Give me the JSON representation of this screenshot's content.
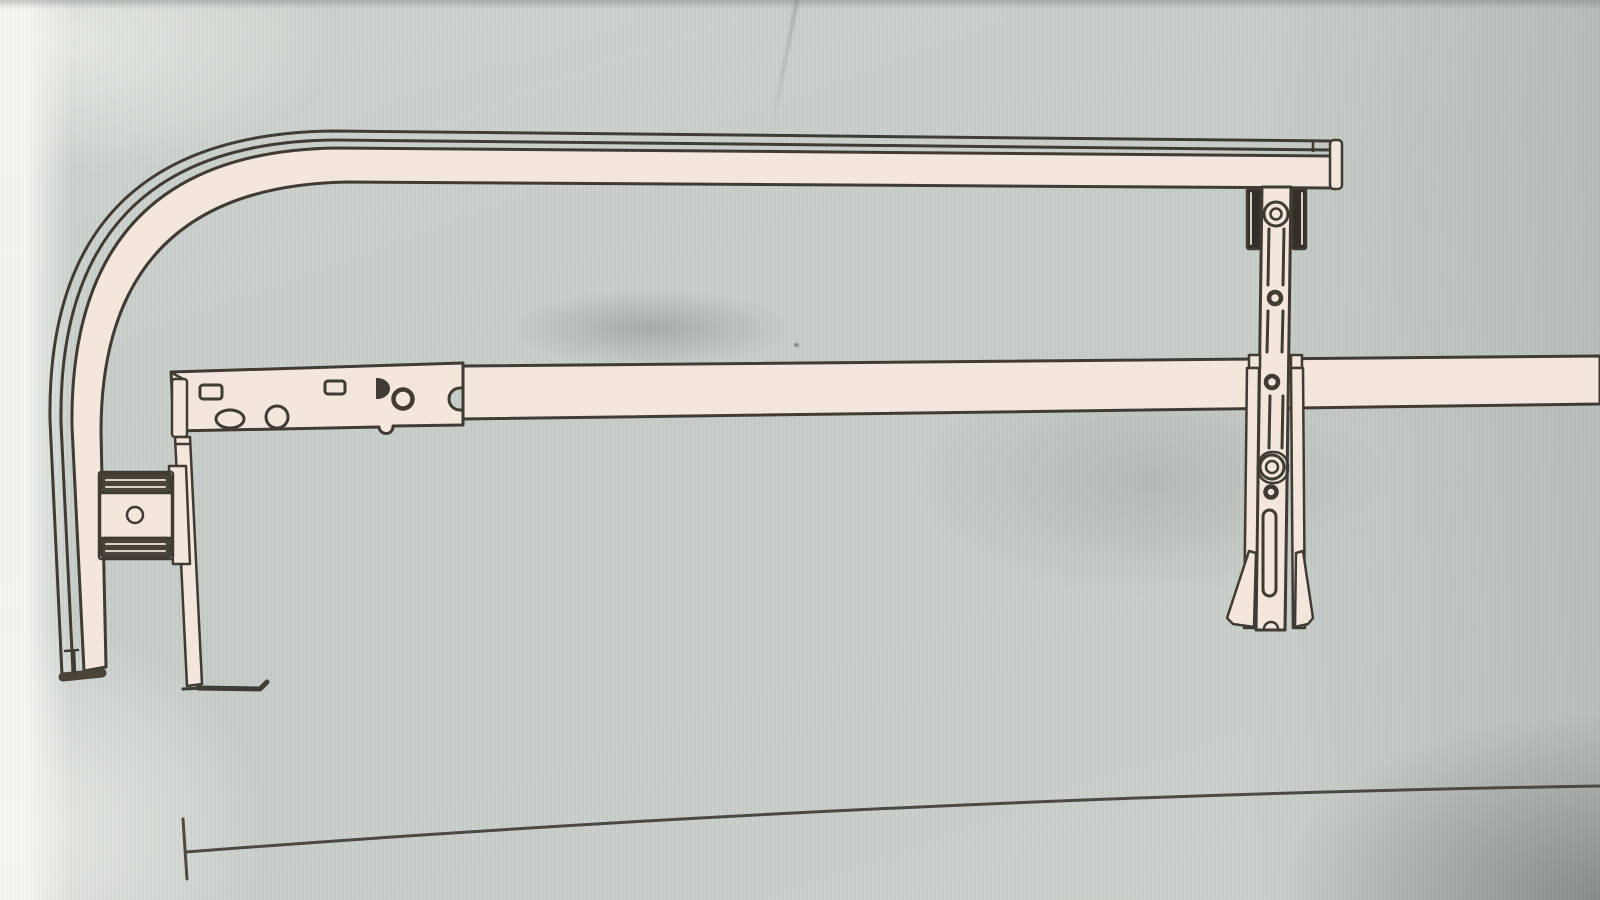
{
  "page": {
    "kind": "photograph of a printed instruction line-drawing",
    "title": "Rail assembly diagram: curved track rail, support bar with slotted mounting plate, rail clamp and adjustable hanger bracket",
    "visible_text": []
  },
  "colors": {
    "paper": "#c9cfca",
    "paper_bright": "#f4f6f1",
    "part_fill": "#f4e7de",
    "line": "#3c372f",
    "line_soft": "#4b453c",
    "dark_fill": "#453f35",
    "black_fill": "#2e2a24",
    "jaw_rib": "#d9d3c7"
  },
  "diagram": {
    "parts": [
      {
        "id": "curved-track-rail",
        "label": "long top rail with 90-degree curved return dropping on the left"
      },
      {
        "id": "rail-end-cap",
        "label": "end cap on the right tip of the top rail"
      },
      {
        "id": "rail-bottom-cap",
        "label": "dark end cap at the bottom of the curved return"
      },
      {
        "id": "support-bar",
        "label": "horizontal support bar running off the right edge"
      },
      {
        "id": "mounting-plate",
        "label": "slotted mounting plate with square, oval, round and half-round holes"
      },
      {
        "id": "drop-leg",
        "label": "vertical drop leg with horizontal foot line"
      },
      {
        "id": "rail-clamp",
        "label": "clamp with two dark ribbed jaws and a bolt hole gripping the curved rail"
      },
      {
        "id": "hanger-bracket",
        "label": "vertical adjustable hanger bracket with slots, rings and side clamp blocks"
      },
      {
        "id": "bracket-foot-fins",
        "label": "flared foot fins at the bottom of the hanger bracket"
      },
      {
        "id": "dimension-line",
        "label": "baseline dimension line with left end tick"
      }
    ]
  }
}
